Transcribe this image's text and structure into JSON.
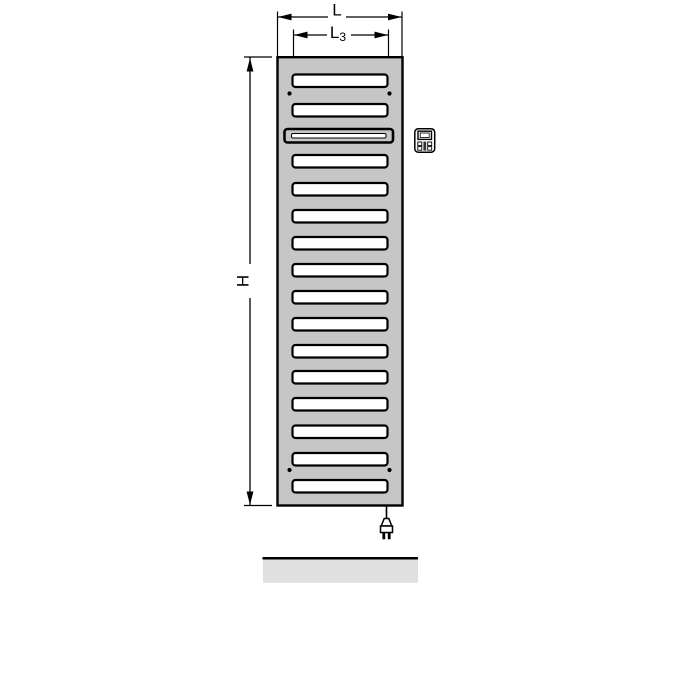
{
  "drawing": {
    "type": "technical-dimension-diagram",
    "subject": "electric towel radiator, front view",
    "labels": {
      "overall_width": "L",
      "slat_width_base": "L",
      "slat_width_subscript": "3",
      "overall_height": "H"
    },
    "colors": {
      "radiator_fill": "#c6c6c6",
      "slat_fill": "#ffffff",
      "outline": "#000000",
      "floor_fill": "#e0e0e0"
    },
    "radiator": {
      "slat_count": 16,
      "slats": [
        {
          "y": 74.5,
          "type": "regular"
        },
        {
          "y": 104,
          "type": "regular"
        },
        {
          "y": 129,
          "type": "heating"
        },
        {
          "y": 155,
          "type": "regular"
        },
        {
          "y": 183,
          "type": "regular"
        },
        {
          "y": 210,
          "type": "regular"
        },
        {
          "y": 237,
          "type": "regular"
        },
        {
          "y": 264,
          "type": "regular"
        },
        {
          "y": 291,
          "type": "regular"
        },
        {
          "y": 318,
          "type": "regular"
        },
        {
          "y": 345,
          "type": "regular"
        },
        {
          "y": 371,
          "type": "regular"
        },
        {
          "y": 398,
          "type": "regular"
        },
        {
          "y": 425.5,
          "type": "regular"
        },
        {
          "y": 453,
          "type": "regular"
        },
        {
          "y": 480,
          "type": "regular"
        }
      ],
      "screw_positions": [
        {
          "x": 289.5,
          "y": 93.5
        },
        {
          "x": 389.5,
          "y": 93.5
        },
        {
          "x": 289.5,
          "y": 470
        },
        {
          "x": 389.5,
          "y": 470
        }
      ]
    },
    "icons": {
      "control_unit": "control-unit-icon",
      "power_plug": "power-plug-icon"
    }
  }
}
